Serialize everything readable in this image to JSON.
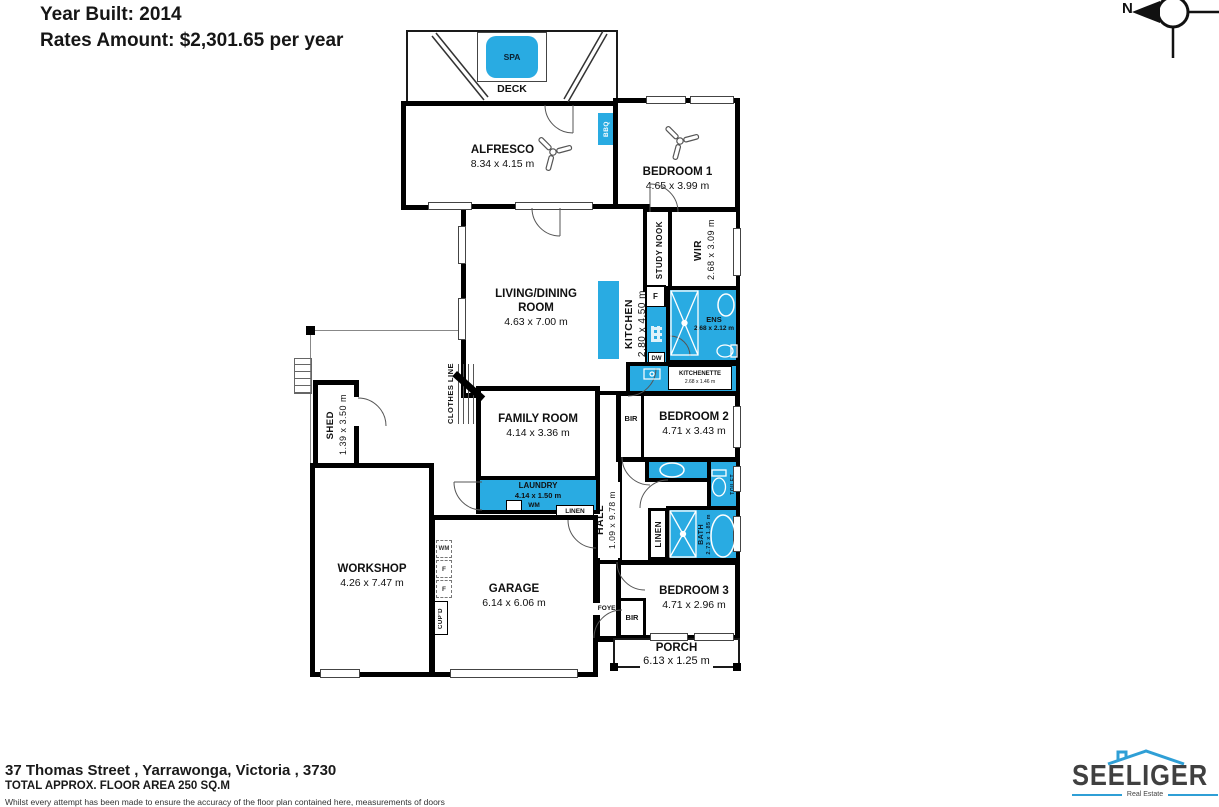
{
  "header": {
    "year_built": "Year Built: 2014",
    "rates": "Rates Amount: $2,301.65 per year"
  },
  "compass": {
    "label": "N"
  },
  "colors": {
    "fixture_blue": "#29abe2",
    "wall_black": "#000000",
    "logo_blue": "#2f9fd6"
  },
  "rooms": {
    "spa": {
      "name": "SPA"
    },
    "deck": {
      "name": "DECK"
    },
    "alfresco": {
      "name": "ALFRESCO",
      "dims": "8.34 x 4.15 m"
    },
    "bbq": {
      "name": "BBQ"
    },
    "bedroom1": {
      "name": "BEDROOM 1",
      "dims": "4.65 x 3.99 m"
    },
    "study_nook": {
      "name": "STUDY NOOK"
    },
    "wir": {
      "name": "WIR",
      "dims": "2.68 x 3.09 m"
    },
    "living_dining": {
      "name_line1": "LIVING/DINING",
      "name_line2": "ROOM",
      "dims": "4.63 x 7.00 m"
    },
    "kitchen": {
      "name": "KITCHEN",
      "dims": "2.80 x 4.50 m"
    },
    "fridge": {
      "name": "F"
    },
    "dishwasher": {
      "name": "DW"
    },
    "ens": {
      "name": "ENS",
      "dims": "2.68 x 2.12 m"
    },
    "kitchenette": {
      "name": "KITCHENETTE",
      "dims": "2.68 x 1.46 m"
    },
    "shed": {
      "name": "SHED",
      "dims": "1.39 x 3.50 m"
    },
    "clothes_line": {
      "name": "CLOTHES LINE"
    },
    "family_room": {
      "name": "FAMILY ROOM",
      "dims": "4.14 x 3.36 m"
    },
    "bir_bedroom2": {
      "name": "BIR"
    },
    "bedroom2": {
      "name": "BEDROOM 2",
      "dims": "4.71 x 3.43 m"
    },
    "laundry": {
      "name": "LAUNDRY",
      "dims": "4.14 x 1.50 m",
      "wm": "WM"
    },
    "linen_laundry": {
      "name": "LINEN"
    },
    "cupd_laundry": {
      "name": "CUP'D"
    },
    "hall": {
      "name": "HALL",
      "dims": "1.09 x 9.78 m"
    },
    "toilet": {
      "name": "TOILET"
    },
    "linen_hall": {
      "name": "LINEN"
    },
    "bath": {
      "name": "BATH",
      "dims": "2.73 x 1.85 m"
    },
    "workshop": {
      "name": "WORKSHOP",
      "dims": "4.26 x 7.47 m"
    },
    "wm_garage": {
      "name": "WM"
    },
    "freezer1": {
      "name": "F"
    },
    "freezer2": {
      "name": "F"
    },
    "cupd_garage": {
      "name": "CUP'D"
    },
    "garage": {
      "name": "GARAGE",
      "dims": "6.14 x 6.06 m"
    },
    "foyer": {
      "name": "FOYER"
    },
    "bir_bedroom3": {
      "name": "BIR"
    },
    "bedroom3": {
      "name": "BEDROOM 3",
      "dims": "4.71 x 2.96 m"
    },
    "porch": {
      "name": "PORCH",
      "dims": "6.13 x 1.25 m"
    }
  },
  "footer": {
    "address": "37 Thomas Street , Yarrawonga, Victoria , 3730",
    "floor_area": "TOTAL APPROX. FLOOR AREA 250 SQ.M",
    "disclaimer": "Whilst every attempt has been made to ensure the accuracy of the floor plan contained here, measurements of doors"
  },
  "logo": {
    "name": "SEELIGER",
    "tagline": "Real Estate"
  }
}
